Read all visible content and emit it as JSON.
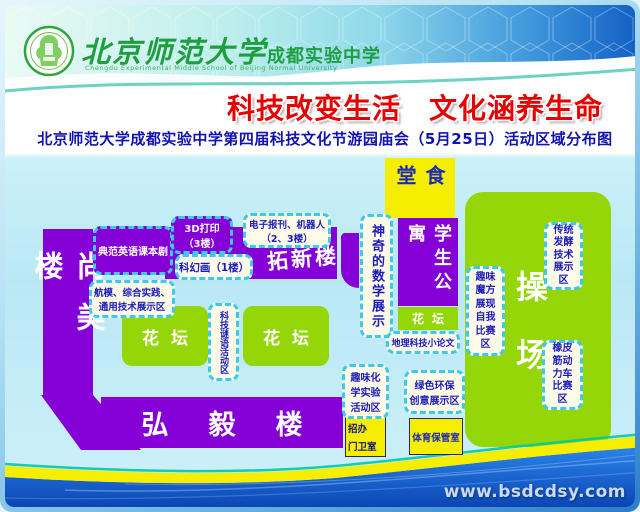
{
  "header": {
    "school_name_cn_main": "北京师范大学",
    "school_name_cn_sub": "成都实验中学",
    "school_name_en": "Chengdu Experimental Middle School of Beijing Normal University",
    "title_left": "科技改变生活",
    "title_right": "文化涵养生命",
    "subtitle": "北京师范大学成都实验中学第四届科技文化节游园庙会（5月25日）活动区域分布图"
  },
  "map": {
    "buildings": {
      "shangmei": "尚美楼",
      "tuoxin": "拓新楼",
      "hongyi": "弘毅楼",
      "dorm": "学生公寓"
    },
    "rooms": {
      "canteen": "食堂",
      "admissions": {
        "lines": [
          "招办",
          "门卫室"
        ]
      },
      "sports_storage": "体育保管室"
    },
    "green": {
      "flowerbed_left": "花坛",
      "flowerbed_center": "花坛",
      "flowerbed_small": "花坛",
      "playground": "操场"
    },
    "activities": {
      "english_drama": {
        "text": "典范英语课本剧"
      },
      "printing_3d": {
        "lines": [
          "3D打印",
          "（3楼）"
        ]
      },
      "epaper_robot": {
        "lines": [
          "电子报刊、机器人",
          "（2、3楼）"
        ]
      },
      "scifi_painting": {
        "text": "科幻画（1楼）"
      },
      "aeromodel": {
        "lines": [
          "航模、综合实践、",
          "通用技术展示区"
        ]
      },
      "riddle": {
        "text": "科技谜语活动区"
      },
      "math_magic": {
        "text": "神奇的数学展示"
      },
      "geography_essay": {
        "text": "地理科技小论文"
      },
      "chemistry": {
        "lines": [
          "趣味化",
          "学实验",
          "活动区"
        ]
      },
      "eco_creative": {
        "lines": [
          "绿色环保",
          "创意展示区"
        ]
      },
      "rubiks_cube": {
        "lines": [
          "趣味",
          "魔方",
          "展现",
          "自我",
          "比赛",
          "区"
        ]
      },
      "fermentation": {
        "lines": [
          "传统",
          "发酵",
          "技术",
          "展示",
          "区"
        ]
      },
      "rubber_band_car": {
        "lines": [
          "橡皮",
          "筋动",
          "力车",
          "比赛",
          "区"
        ]
      }
    },
    "colors": {
      "building_purple": "#8400d6",
      "area_green": "#94d607",
      "room_yellow": "#f6ee00",
      "dash_border_cyan": "#3cc9ea",
      "label_blue": "#1c1cb8",
      "title_red": "#e60000"
    }
  },
  "footer": {
    "watermark": "www.bsdcdsy.com"
  }
}
